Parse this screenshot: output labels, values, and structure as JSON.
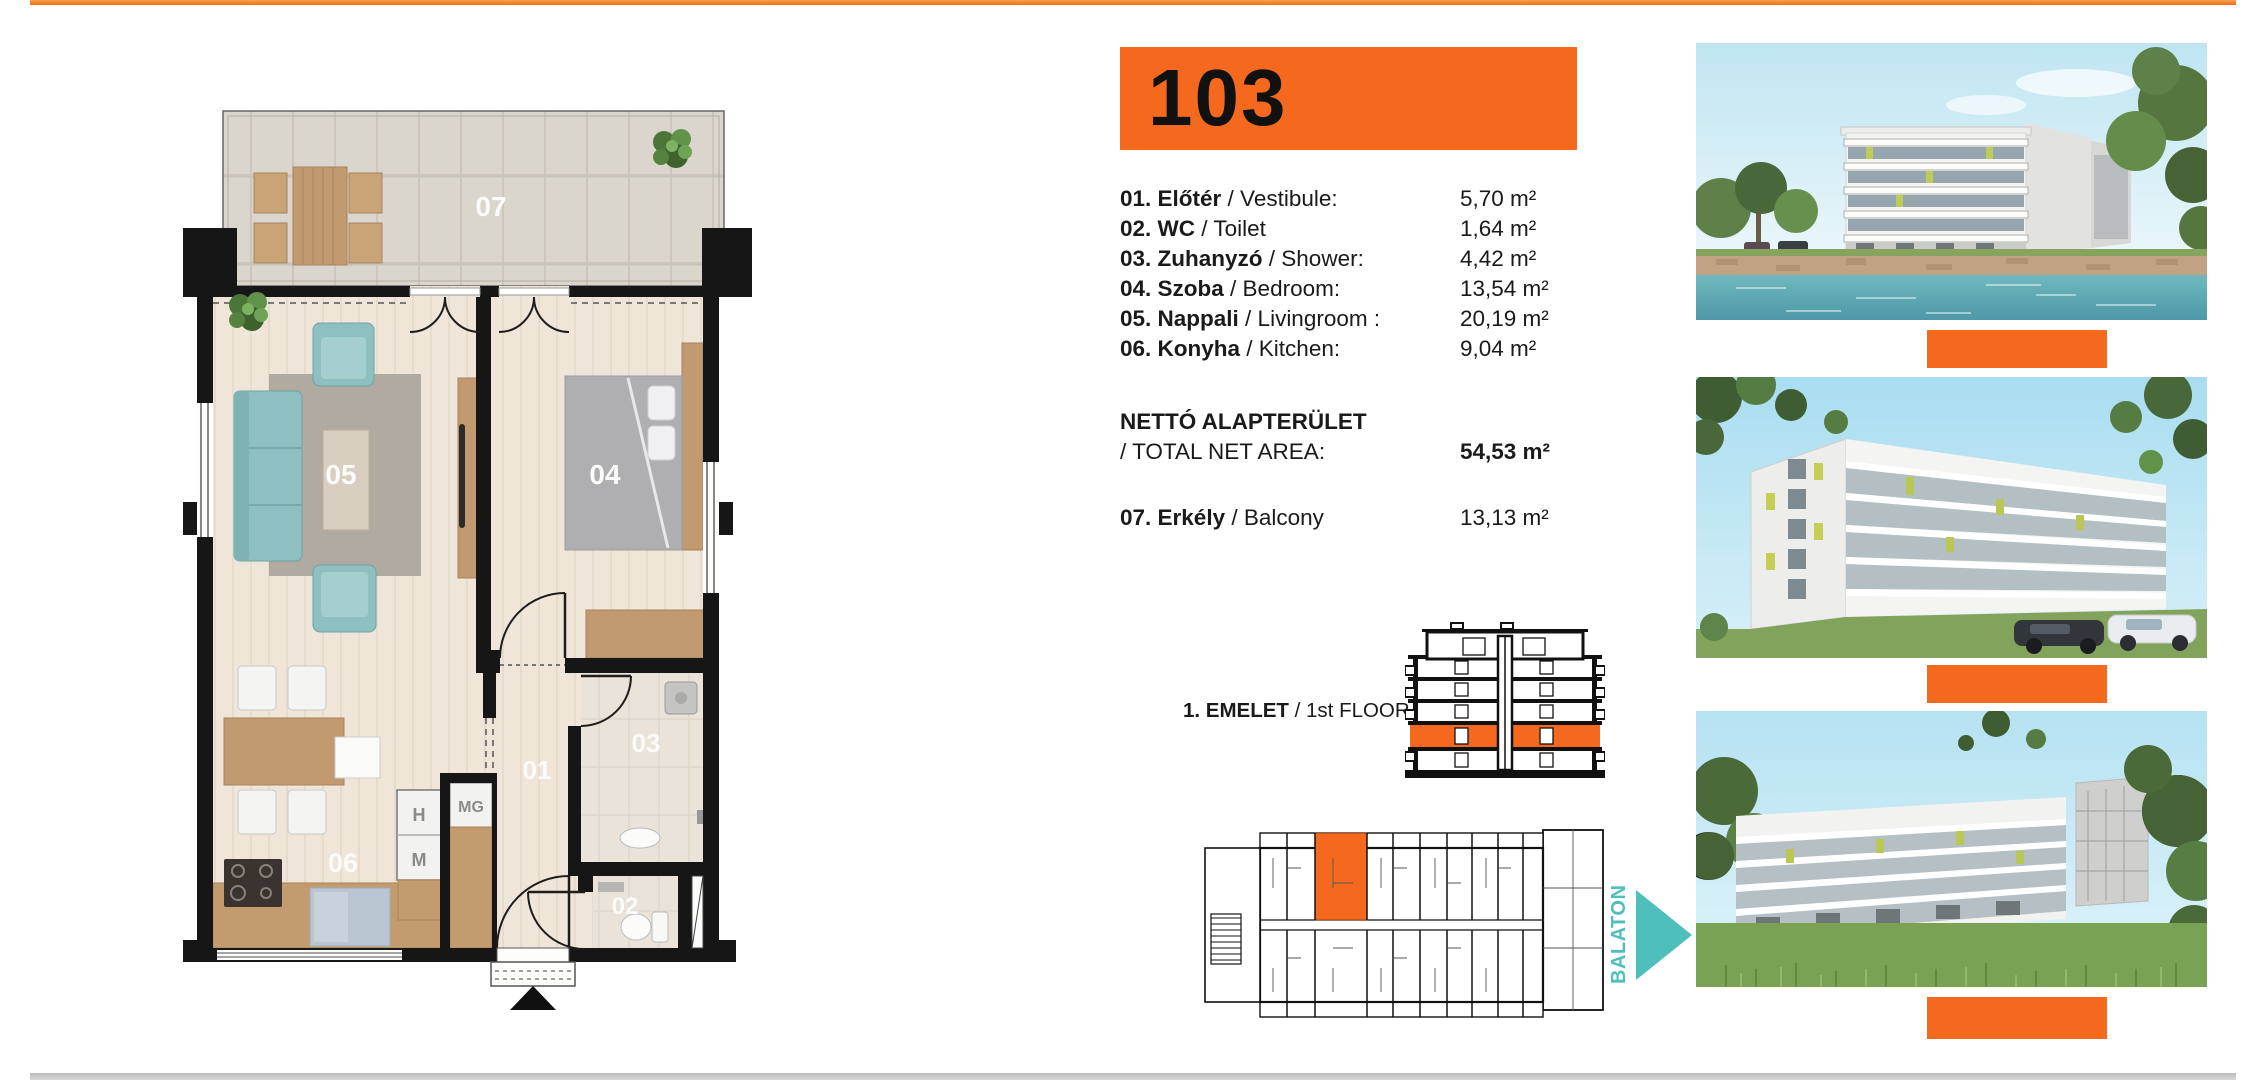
{
  "colors": {
    "accent": "#F4691E",
    "teal": "#4EBFBA",
    "wall": "#161616"
  },
  "unit": {
    "number": "103"
  },
  "rooms": [
    {
      "bold": "01. Előtér",
      "rest": " / Vestibule:",
      "area": "5,70 m²"
    },
    {
      "bold": "02. WC",
      "rest": " / Toilet",
      "area": "1,64 m²"
    },
    {
      "bold": "03. Zuhanyzó",
      "rest": " / Shower:",
      "area": "4,42 m²"
    },
    {
      "bold": "04. Szoba",
      "rest": " / Bedroom:",
      "area": "13,54 m²"
    },
    {
      "bold": "05. Nappali",
      "rest": " / Livingroom :",
      "area": "20,19 m²"
    },
    {
      "bold": "06. Konyha",
      "rest": " / Kitchen:",
      "area": "9,04 m²"
    }
  ],
  "total": {
    "label_hu": "NETTÓ ALAPTERÜLET",
    "label_en": " / TOTAL NET AREA:",
    "value": "54,53 m²"
  },
  "balcony_row": {
    "bold": "07. Erkély",
    "rest": " / Balcony",
    "area": "13,13 m²"
  },
  "floor_indicator": {
    "bold": "1. EMELET",
    "rest": " / 1st FLOOR"
  },
  "site": {
    "direction_label": "BALATON"
  },
  "floorplan": {
    "labels": {
      "r01": "01",
      "r02": "02",
      "r03": "03",
      "r04": "04",
      "r05": "05",
      "r06": "06",
      "r07": "07"
    },
    "appliances": {
      "h": "H",
      "m": "M",
      "mg": "MG"
    }
  },
  "photos": [
    {
      "name": "render-lakeside"
    },
    {
      "name": "render-street-corner"
    },
    {
      "name": "render-garden-facade"
    }
  ]
}
